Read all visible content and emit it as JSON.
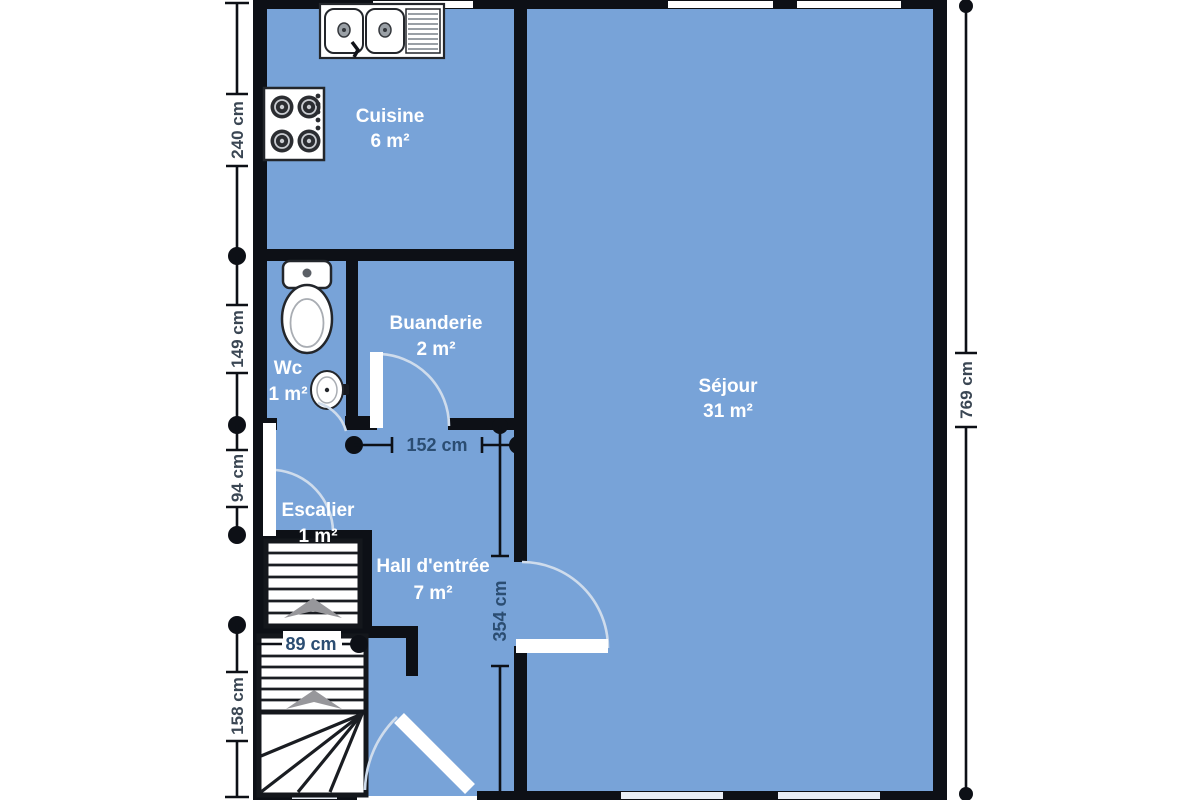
{
  "rooms": {
    "cuisine": {
      "name": "Cuisine",
      "area": "6 m²"
    },
    "buanderie": {
      "name": "Buanderie",
      "area": "2 m²"
    },
    "wc": {
      "name": "Wc",
      "area": "1 m²"
    },
    "sejour": {
      "name": "Séjour",
      "area": "31 m²"
    },
    "escalier": {
      "name": "Escalier",
      "area": "1 m²"
    },
    "hall": {
      "name": "Hall d'entrée",
      "area": "7 m²"
    }
  },
  "dimensions": {
    "left_kitchen": "240 cm",
    "left_wc": "149 cm",
    "left_stairs_mid": "94 cm",
    "left_stairs_bottom": "158 cm",
    "right_total": "769 cm",
    "hall_width": "152 cm",
    "hall_depth": "354 cm",
    "stair_width": "89 cm"
  },
  "colors": {
    "floor": "#78a3d8",
    "wall": "#0d1016",
    "room_label": "#ffffff",
    "dimension_label": "#3a4653",
    "interior_dimension_label": "#2b4d72",
    "door_arc": "#cfdcec",
    "stair_arrow": "#97979b",
    "window_light": "#e9eef6"
  }
}
